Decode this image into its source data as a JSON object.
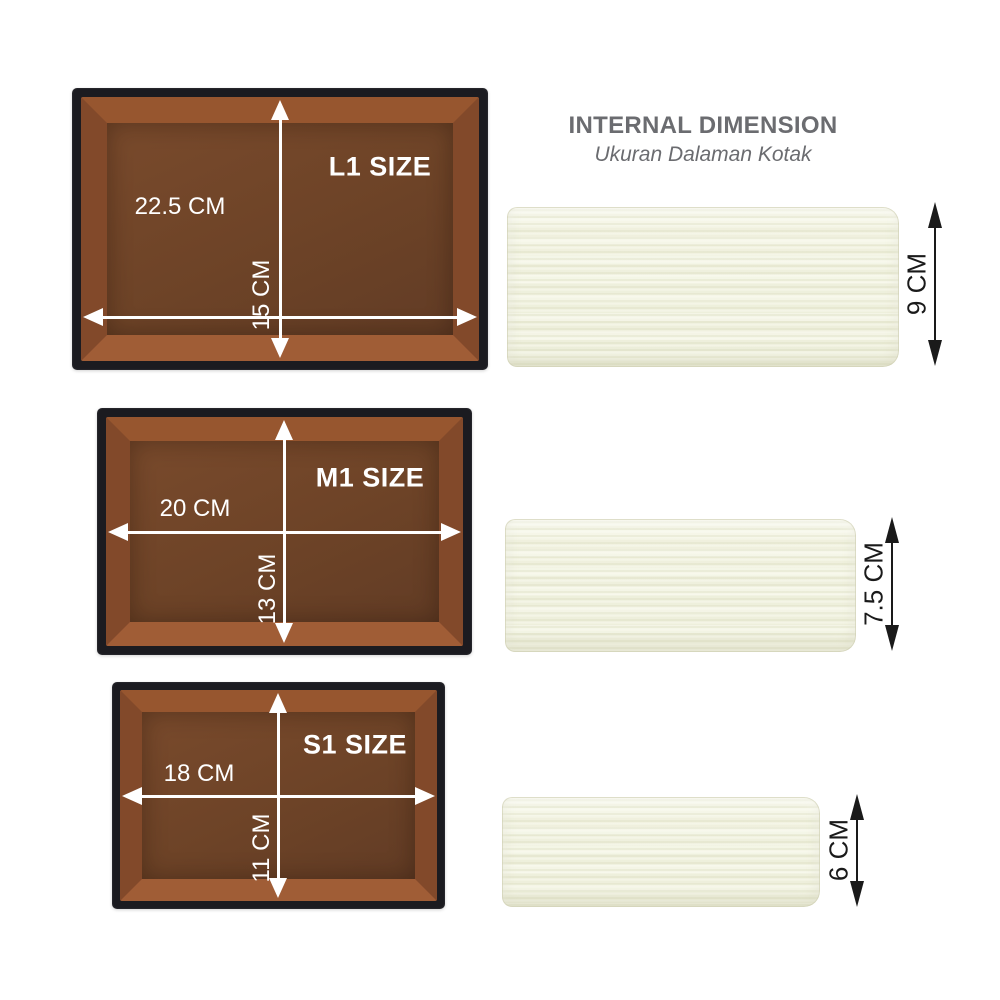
{
  "header": {
    "title": "INTERNAL DIMENSION",
    "subtitle": "Ukuran Dalaman Kotak"
  },
  "boxes": [
    {
      "id": "L1",
      "size_label": "L1 SIZE",
      "inner_width": "22.5 CM",
      "inner_length": "15 CM",
      "inner_height": "9 CM"
    },
    {
      "id": "M1",
      "size_label": "M1 SIZE",
      "inner_width": "20 CM",
      "inner_length": "13 CM",
      "inner_height": "7.5 CM"
    },
    {
      "id": "S1",
      "size_label": "S1 SIZE",
      "inner_width": "18 CM",
      "inner_length": "11 CM",
      "inner_height": "6 CM"
    }
  ],
  "colors": {
    "background": "#ffffff",
    "box_rim": "#1b1b20",
    "wall_top": "#97562f",
    "wall_side": "#82492a",
    "wall_bottom": "#a05d36",
    "floor": "#6d4327",
    "cream_box": "#f2f3e3",
    "title_text": "#6b6c70",
    "dimension_text_light": "#ffffff",
    "dimension_text_dark": "#1a1a1a"
  }
}
